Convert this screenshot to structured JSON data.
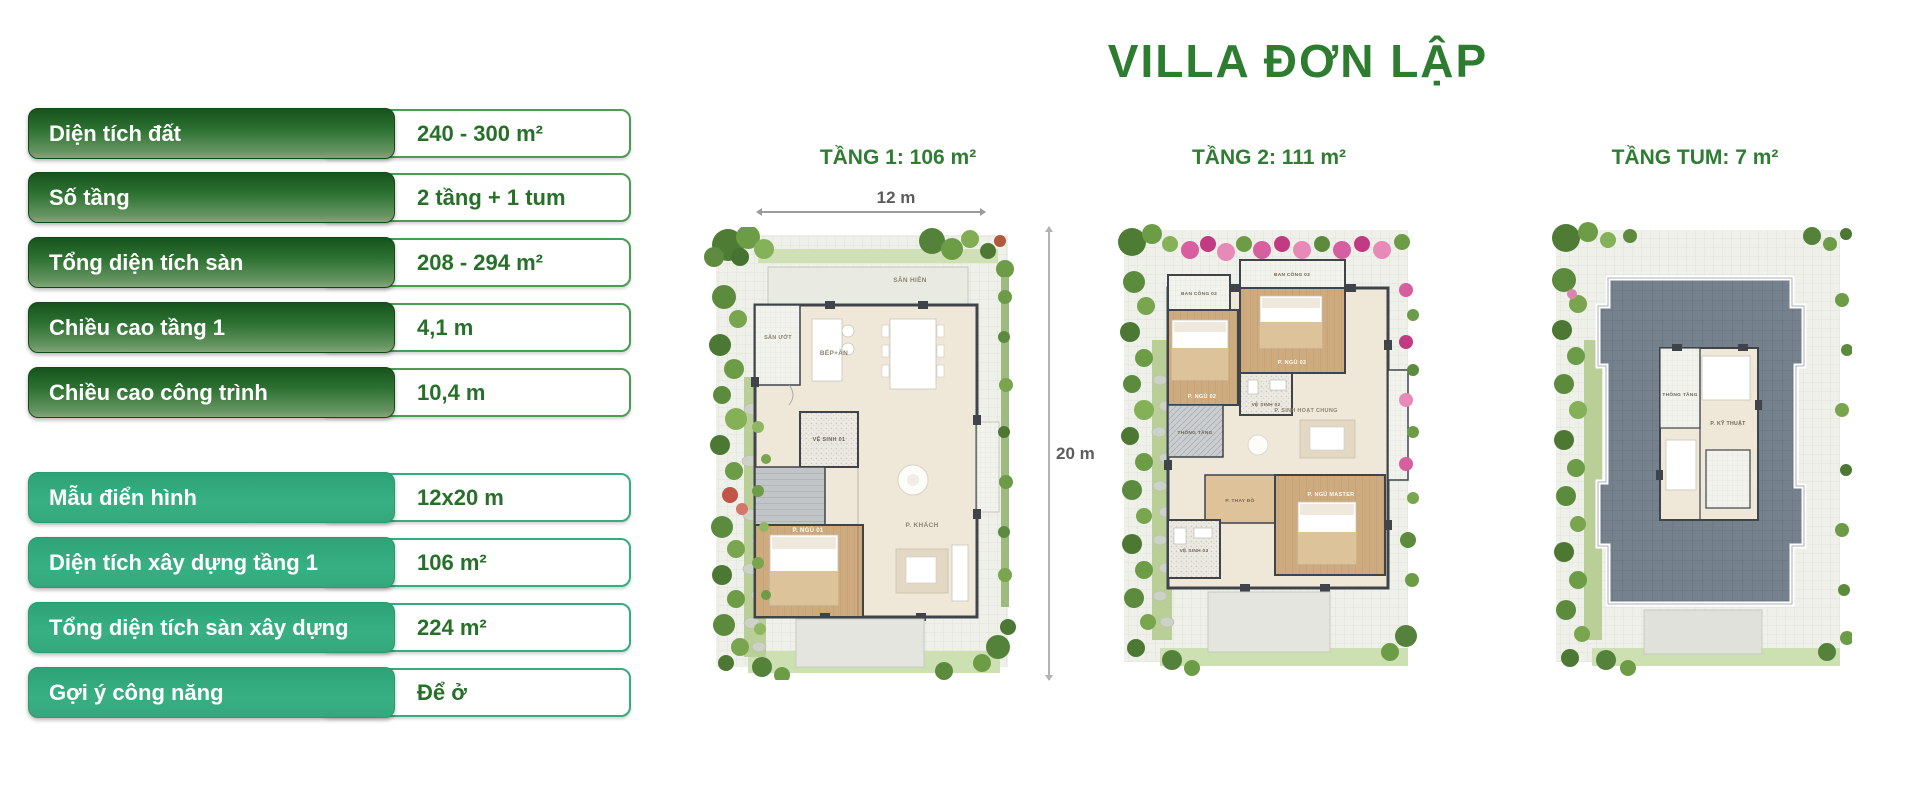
{
  "title": "VILLA ĐƠN LẬP",
  "colors": {
    "title_green": "#2d7c30",
    "dark_green_gradient_top": "#17531d",
    "dark_green_gradient_bottom": "#84a57c",
    "emerald": "#36ad7f",
    "value_text_green": "#26702a",
    "heading_green": "#2f7d33"
  },
  "spec_table": {
    "group1": [
      {
        "label": "Diện tích đất",
        "value": "240 - 300 m²"
      },
      {
        "label": "Số tầng",
        "value": "2 tầng + 1 tum"
      },
      {
        "label": "Tổng diện tích sàn",
        "value": "208 - 294 m²"
      },
      {
        "label": "Chiều cao tầng 1",
        "value": "4,1 m"
      },
      {
        "label": "Chiều cao công trình",
        "value": "10,4 m"
      }
    ],
    "group2": [
      {
        "label": "Mẫu điển hình",
        "value": "12x20 m"
      },
      {
        "label": "Diện tích xây dựng tầng 1",
        "value": "106 m²"
      },
      {
        "label": "Tổng diện tích sàn xây dựng",
        "value": "224 m²"
      },
      {
        "label": "Gợi ý công năng",
        "value": "Để ở"
      }
    ]
  },
  "plans": [
    {
      "heading": "TẦNG 1:  106 m²",
      "dims": {
        "width": "12 m",
        "height": "20 m"
      },
      "rooms": {
        "porch": "SÂN HIÊN",
        "wet_yard": "SÂN ƯỚT",
        "kitchen": "BẾP+ĂN",
        "wc1": "VỆ SINH 01",
        "living": "P. KHÁCH",
        "bedroom1": "P. NGỦ 01"
      }
    },
    {
      "heading": "TẦNG 2: 111 m²",
      "rooms": {
        "balcony2": "BAN CÔNG 02",
        "balcony3": "BAN CÔNG 03",
        "bedroom3": "P. NGỦ 03",
        "bedroom2": "P. NGỦ 02",
        "wc2": "VỆ SINH 02",
        "void": "THÔNG TẦNG",
        "family": "P. SINH HOẠT CHUNG",
        "dressing": "P. THAY ĐỒ",
        "master": "P. NGỦ MASTER",
        "wc3": "VỆ SINH 03"
      }
    },
    {
      "heading": "TẦNG TUM: 7 m²",
      "rooms": {
        "void": "THÔNG TẦNG",
        "technical": "P. KỸ THUẬT"
      }
    }
  ]
}
